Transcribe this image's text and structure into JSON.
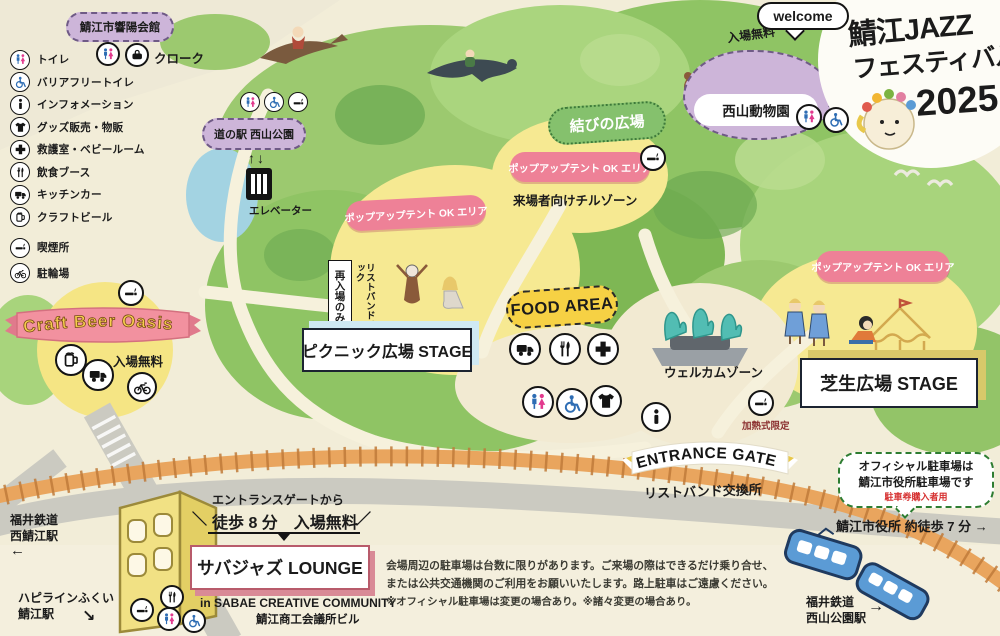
{
  "logo": {
    "line1": "鯖江JAZZ",
    "line2": "フェスティバル",
    "year": "2025"
  },
  "zoo": {
    "welcome": "welcome",
    "free": "入場無料",
    "name": "西山動物園"
  },
  "legend": {
    "items": [
      {
        "icon": "toilet-icon",
        "label": "トイレ"
      },
      {
        "icon": "wheelchair-icon",
        "label": "バリアフリートイレ"
      },
      {
        "icon": "info-icon",
        "label": "インフォメーション"
      },
      {
        "icon": "goods-icon",
        "label": "グッズ販売・物販"
      },
      {
        "icon": "first-aid-icon",
        "label": "救護室・ベビールーム"
      },
      {
        "icon": "food-booth-icon",
        "label": "飲食ブース"
      },
      {
        "icon": "kitchen-car-icon",
        "label": "キッチンカー"
      },
      {
        "icon": "craft-beer-icon",
        "label": "クラフトビール"
      },
      {
        "icon": "smoking-icon",
        "label": "喫煙所"
      },
      {
        "icon": "bicycle-icon",
        "label": "駐輪場"
      }
    ]
  },
  "kyoyo": {
    "name": "鯖江市響陽会館",
    "cloak": "クローク"
  },
  "michinoeki": {
    "name": "道の駅 西山公園",
    "elevator": "エレベーター",
    "elevator_arrows": "↑↓"
  },
  "musubi": {
    "name": "結びの広場",
    "popup": "ポップアップテント OK エリア",
    "chill": "来場者向けチルゾーン"
  },
  "picnic": {
    "popup": "ポップアップテント OK エリア",
    "reentry": "再入場のみ",
    "wristband_check": "リストバンドチェック",
    "stage": "ピクニック広場 STAGE"
  },
  "food": {
    "name": "FOOD AREA"
  },
  "welcome_zone": {
    "name": "ウェルカムゾーン",
    "heated": "加熱式限定"
  },
  "entrance": {
    "name": "ENTRANCE GATE",
    "wristband": "リストバンド交換所"
  },
  "shibafu": {
    "popup": "ポップアップテント OK エリア",
    "stage": "芝生広場 STAGE"
  },
  "craft": {
    "name": "Craft Beer Oasis",
    "free": "入場無料"
  },
  "lounge": {
    "from": "エントランスゲートから",
    "deco_l": "＼",
    "deco_r": "／",
    "walk": "徒歩 8 分　入場無料",
    "name": "サバジャズ LOUNGE",
    "community": "in SABAE CREATIVE COMMUNITY",
    "building": "鯖江商工会議所ビル"
  },
  "parking": {
    "line1": "オフィシャル駐車場は",
    "line2": "鯖江市役所駐車場です",
    "note": "駐車券購入者用"
  },
  "cityhall": {
    "label": "鯖江市役所 約徒歩 7 分",
    "arrow": "→"
  },
  "stations": {
    "nishisabae_l1": "福井鉄道",
    "nishisabae_l2": "西鯖江駅",
    "nishisabae_arrow": "←",
    "happiline_l1": "ハピラインふくい",
    "happiline_l2": "鯖江駅",
    "happiline_arrow": "↘",
    "nishiyamakoen_l1": "福井鉄道",
    "nishiyamakoen_l2": "西山公園駅",
    "nishiyamakoen_arrow": "→"
  },
  "notice": {
    "line1": "会場周辺の駐車場は台数に限りがあります。ご来場の際はできるだけ乗り合せ、",
    "line2": "または公共交通機関のご利用をお願いいたします。路上駐車はご遠慮ください。",
    "line3": "※オフィシャル駐車場は変更の場合あり。※諸々変更の場合あり。"
  },
  "colors": {
    "popup_pink": "#ee8197",
    "plaza_yellow": "#f6e992",
    "bubble_purple": "#cdb5d9",
    "musubi_green": "#85c16d",
    "food_yellow": "#f6d144",
    "rail_orange": "#e9a55e",
    "train_blue": "#5b9bd5",
    "road_gray": "#cbcac1"
  }
}
